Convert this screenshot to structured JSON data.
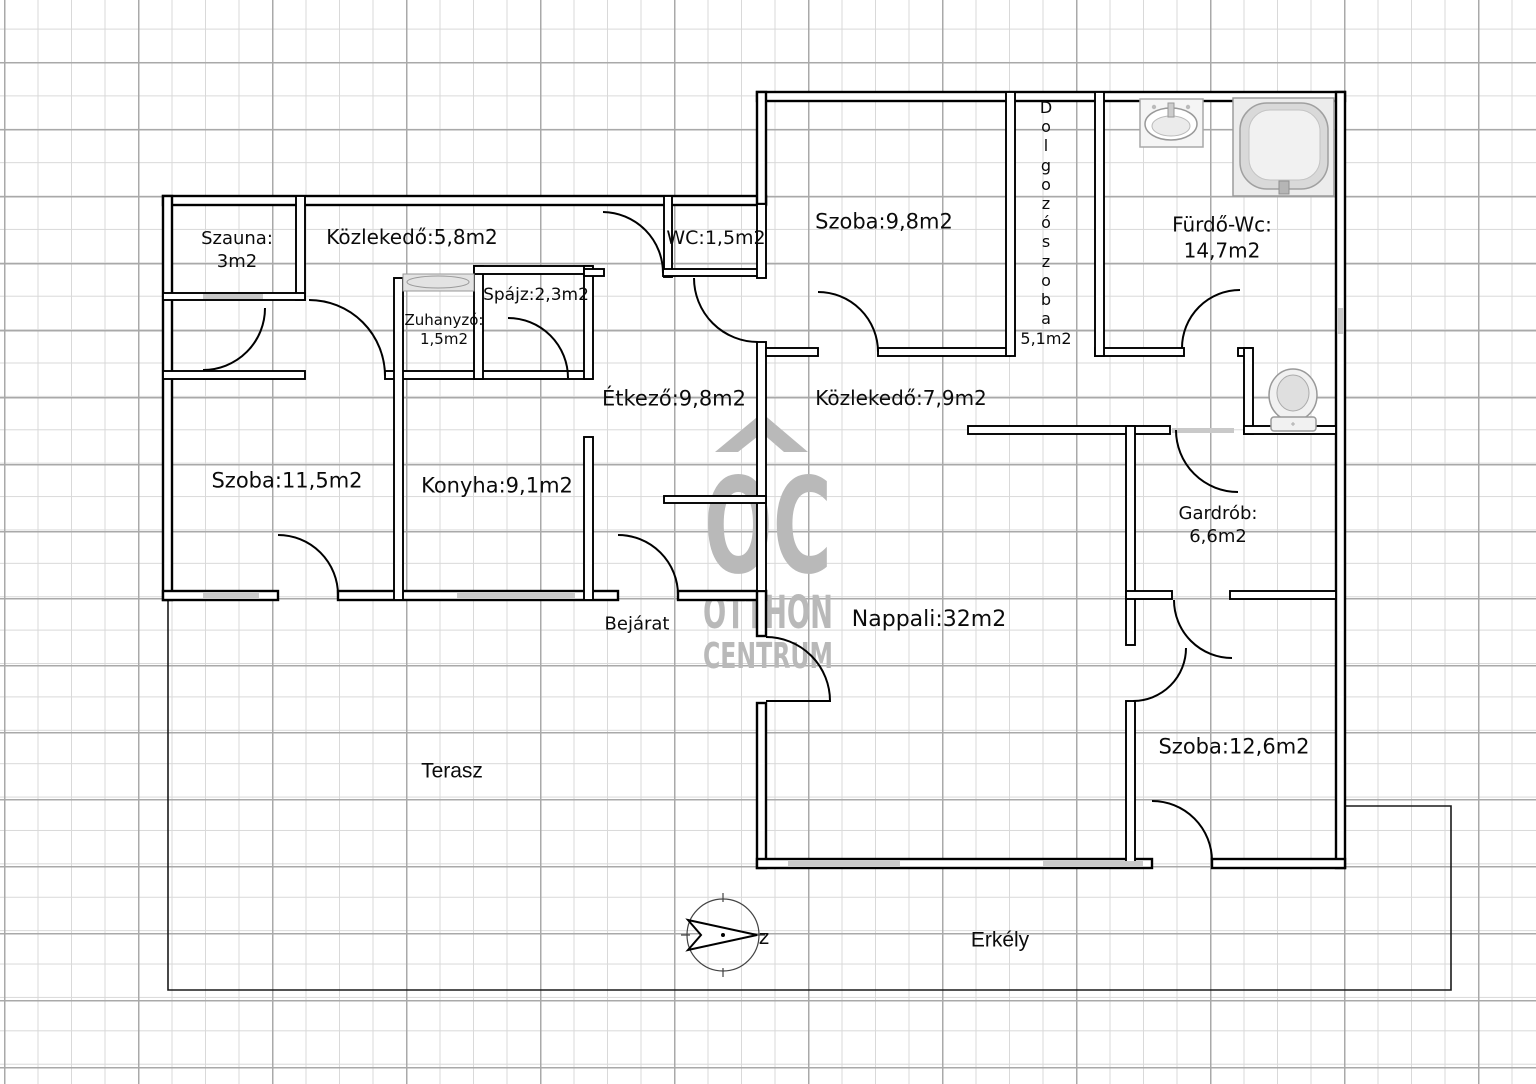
{
  "watermark": {
    "logo_text": "OC",
    "line1": "OTTHON",
    "line2": "CENTRUM"
  },
  "compass": {
    "direction_label": "z"
  },
  "rooms": {
    "szauna": {
      "label": "Szauna:\n3m2"
    },
    "kozlekedo_felso": {
      "label": "Közlekedő:5,8m2"
    },
    "wc": {
      "label": "WC:1,5m2"
    },
    "zuhanyzo": {
      "label": "Zuhanyzó:\n1,5m2"
    },
    "spajz": {
      "label": "Spájz:2,3m2"
    },
    "etkezo": {
      "label": "Étkező:9,8m2"
    },
    "szoba_bal": {
      "label": "Szoba:11,5m2"
    },
    "konyha": {
      "label": "Konyha:9,1m2"
    },
    "szoba_felso": {
      "label": "Szoba:9,8m2"
    },
    "dolgozoszoba": {
      "label_vertical": "D\no\nl\ng\no\nz\nó\ns\nz\no\nb\na",
      "area": "5,1m2"
    },
    "furdo": {
      "label": "Fürdő-Wc:\n14,7m2"
    },
    "kozlekedo_also": {
      "label": "Közlekedő:7,9m2"
    },
    "gardrob": {
      "label": "Gardrób:\n6,6m2"
    },
    "nappali": {
      "label": "Nappali:32m2"
    },
    "szoba_jobb": {
      "label": "Szoba:12,6m2"
    },
    "bejarat": {
      "label": "Bejárat"
    },
    "terasz": {
      "label": "Terasz"
    },
    "erkely": {
      "label": "Erkély"
    }
  },
  "icons": {
    "bathtub": "bathtub-icon",
    "sink": "sink-icon",
    "toilet": "toilet-icon",
    "compass": "compass-icon"
  },
  "colors": {
    "wall": "#000000",
    "grid_minor": "#d9d9d9",
    "grid_major": "#a9a9a9",
    "watermark_gray": "#b9b9b9",
    "fixture_gray": "#ececec"
  }
}
